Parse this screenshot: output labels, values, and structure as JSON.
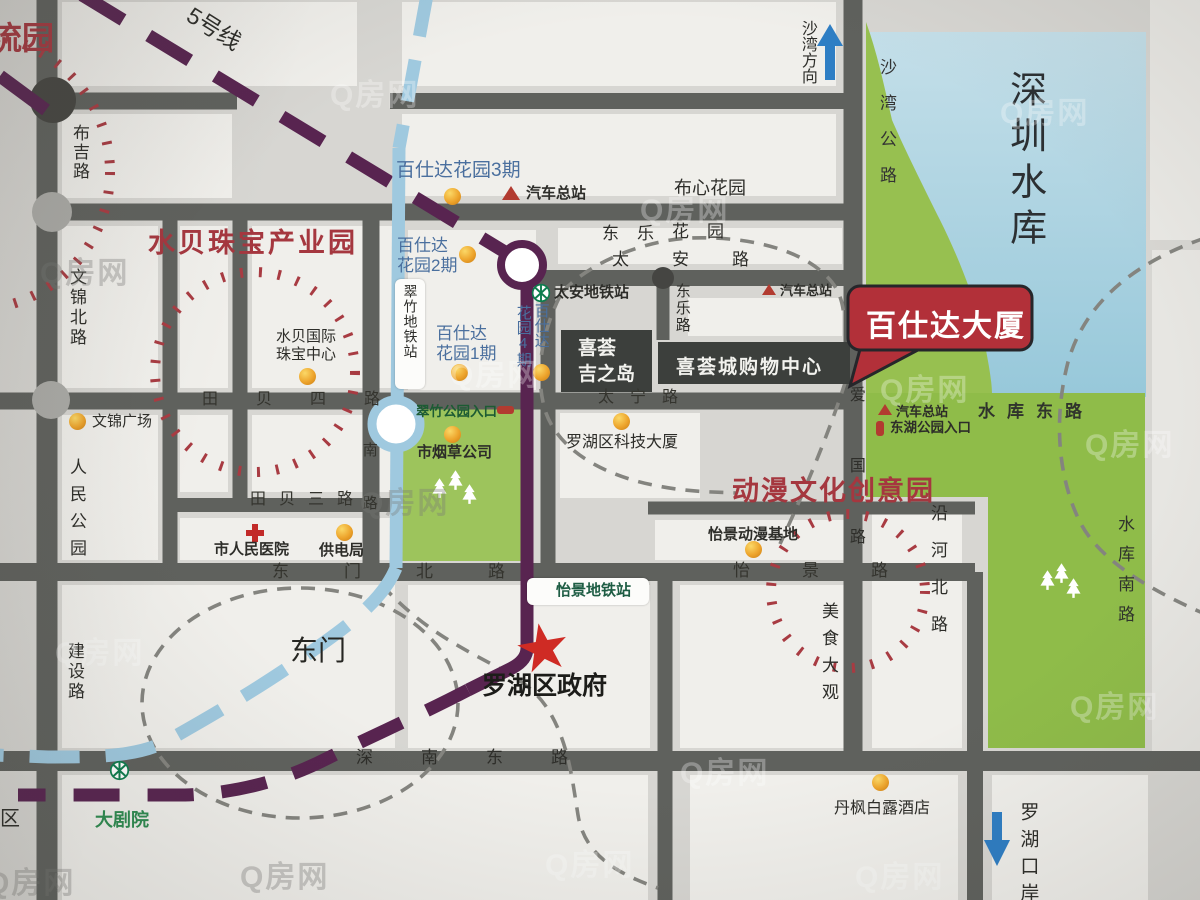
{
  "watermark": "Q房网",
  "colors": {
    "road": "#5f615d",
    "block": "#f0efeb",
    "background": "#d7d6d2",
    "park_green": "#95bf4e",
    "water_blue": "#a9d0e0",
    "metro_purple": "#582450",
    "metro_lightblue": "#9fc9df",
    "accent_red": "#a5373f",
    "callout_red": "#b23039",
    "poi_orange": "#eda42c",
    "metro_logo_green": "#0e7d4e"
  },
  "titles": {
    "shuibei_park": "水贝珠宝产业园",
    "dongman_park": "动漫文化创意园",
    "liuyuan_partial": "流园",
    "reservoir": "深圳水库",
    "dongmen": "东门",
    "luohu_gov": "罗湖区政府",
    "callout": "百仕达大厦"
  },
  "metro": {
    "line5": "5号线",
    "taian_station": "太安地铁站",
    "cuizhu_station": "翠竹地铁站",
    "yijing_station": "怡景地铁站",
    "theater_station": "大剧院"
  },
  "directions": {
    "shawan": "沙湾方向",
    "luohu_port": "罗湖口岸"
  },
  "roads": {
    "buji": "布吉路",
    "wenjin_north": "文锦北路",
    "tianbei4": "田贝四路",
    "tianbei3": "田贝三路",
    "taian": "太安路",
    "taining": "太宁路",
    "dongle": "东乐路",
    "dongmen_north": "东门北路",
    "v8_fragment": "南路",
    "yijing": "怡景路",
    "jianshe": "建设路",
    "shennan_east": "深南东路",
    "aiguo": "爱国路",
    "yanhe_north": "沿河北路",
    "shawan_highway": "沙湾公路",
    "reservoir_east": "水库东路",
    "reservoir_south": "水库南路"
  },
  "places": {
    "bsd3": "百仕达花园3期",
    "bsd2_line1": "百仕达",
    "bsd2_line2": "花园2期",
    "bsd1_line1": "百仕达",
    "bsd1_line2": "花园1期",
    "bsd4_col_right": "百仕达",
    "bsd4_col_left": "花园4期",
    "buxin_garden": "布心花园",
    "dongle_estate": "东乐",
    "huayuan_estate": "花园",
    "xihui_line1": "喜荟",
    "xihui_line2": "吉之岛",
    "xihuicheng_mall": "喜荟城购物中心",
    "shuibei_center_line1": "水贝国际",
    "shuibei_center_line2": "珠宝中心",
    "wenjin_plaza": "文锦广场",
    "renmin_park": "人民公园",
    "tobacco": "市烟草公司",
    "tech_tower": "罗湖区科技大厦",
    "hospital": "市人民医院",
    "power_bureau": "供电局",
    "anime_base": "怡景动漫基地",
    "food_street": "美食大观",
    "hotel": "丹枫白露酒店",
    "qu_partial": "区"
  },
  "markers": {
    "bus_station": "汽车总站",
    "cuizhu_park_entrance": "翠竹公园入口",
    "donghu_park_entrance": "东湖公园入口"
  }
}
